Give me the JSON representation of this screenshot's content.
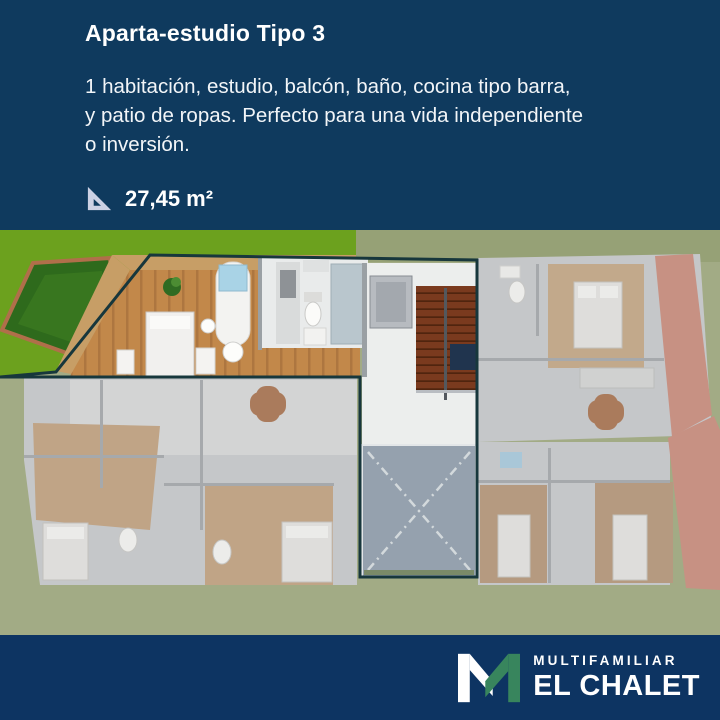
{
  "header": {
    "title": "Aparta-estudio Tipo 3",
    "description_lines": [
      "1 habitación, estudio, balcón, baño, cocina tipo barra,",
      "y patio de ropas. Perfecto para una vida independiente",
      "o inversión."
    ],
    "area": {
      "icon": "set-square-icon",
      "value": "27,45 m²"
    }
  },
  "floorplan": {
    "kind": "3d-floor-plan-render",
    "highlighted_unit": "Aparta-estudio Tipo 3",
    "visible_features": [
      "private-garden",
      "wood-deck",
      "studio-bed",
      "kitchen-bar",
      "bathroom",
      "stairwell",
      "elevator",
      "patio-void",
      "dimmed-neighbor-units",
      "lawn"
    ]
  },
  "footer": {
    "logo_letter": "M",
    "brand_top": "MULTIFAMILIAR",
    "brand_bottom": "EL CHALET"
  },
  "colors": {
    "header_bg": "#0f3a5e",
    "footer_bg": "#0d3462",
    "text": "#ffffff",
    "logo_green": "#38855d",
    "highlight_outline": "#17373c",
    "unit_wood": "#c2884a",
    "lawn_bright": "#6ca11e",
    "lawn_dim": "#a2ab85",
    "icon_lavender": "#ccd1e4"
  }
}
